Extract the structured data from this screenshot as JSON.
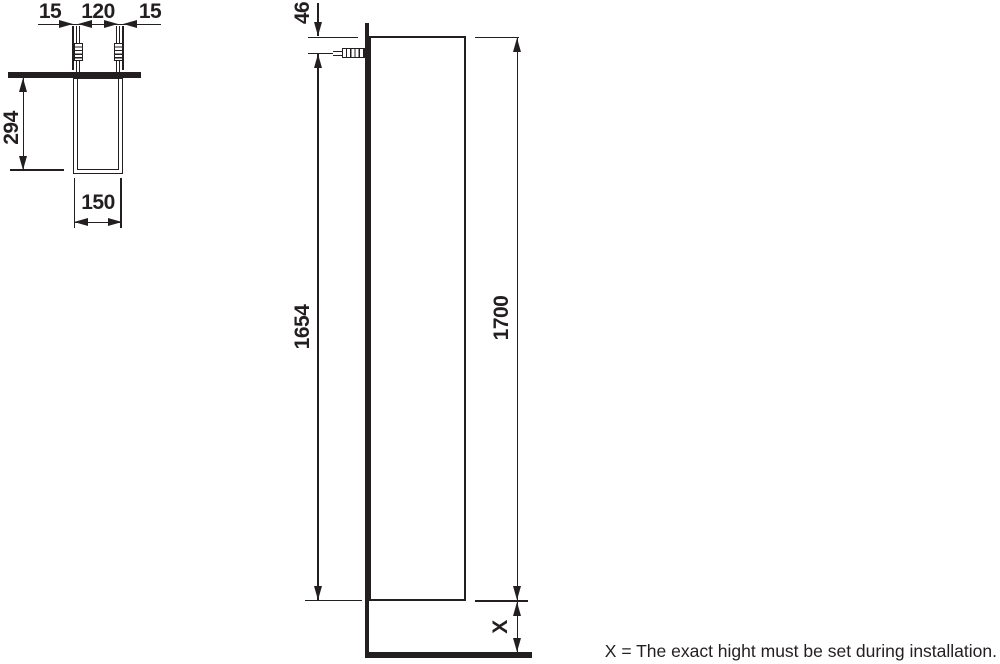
{
  "plan_view": {
    "dims": {
      "left_offset": "15",
      "hole_spacing": "120",
      "right_offset": "15",
      "depth": "294",
      "width": "150"
    }
  },
  "front_view": {
    "dims": {
      "top_offset": "46",
      "rail_to_bottom": "1654",
      "height": "1700",
      "floor_clearance": "X"
    }
  },
  "footnote": "X = The exact hight must be set during installation.",
  "colors": {
    "line": "#231f20",
    "background": "#ffffff"
  }
}
